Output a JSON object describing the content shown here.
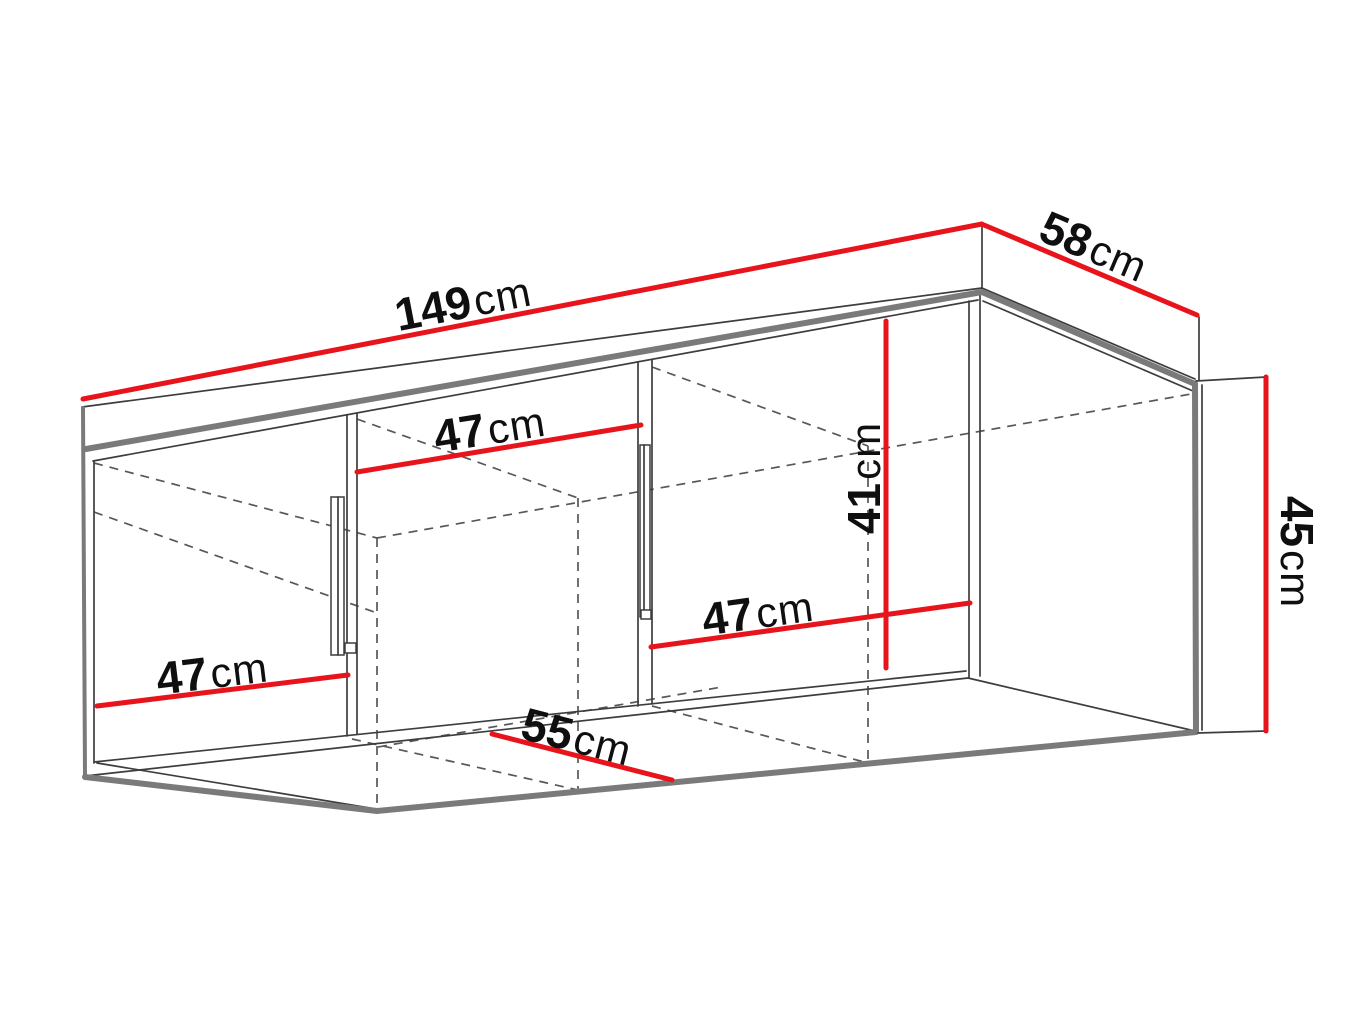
{
  "diagram": {
    "type": "furniture-dimension-drawing",
    "subject": "wall-mounted cabinet with three compartments",
    "unit": "cm",
    "colors": {
      "dimension_line_red": "#e8141c",
      "outline_gray": "#7a7a7a",
      "edge_black": "#3d3d3d",
      "background": "#ffffff"
    },
    "dimensions": {
      "width_top": {
        "value": "149",
        "unit": "cm"
      },
      "depth_top": {
        "value": "58",
        "unit": "cm"
      },
      "height_right": {
        "value": "45",
        "unit": "cm"
      },
      "inner_height": {
        "value": "41",
        "unit": "cm"
      },
      "inner_width_left": {
        "value": "47",
        "unit": "cm"
      },
      "inner_width_middle": {
        "value": "47",
        "unit": "cm"
      },
      "inner_width_right": {
        "value": "47",
        "unit": "cm"
      },
      "depth_bottom": {
        "value": "55",
        "unit": "cm"
      }
    }
  }
}
